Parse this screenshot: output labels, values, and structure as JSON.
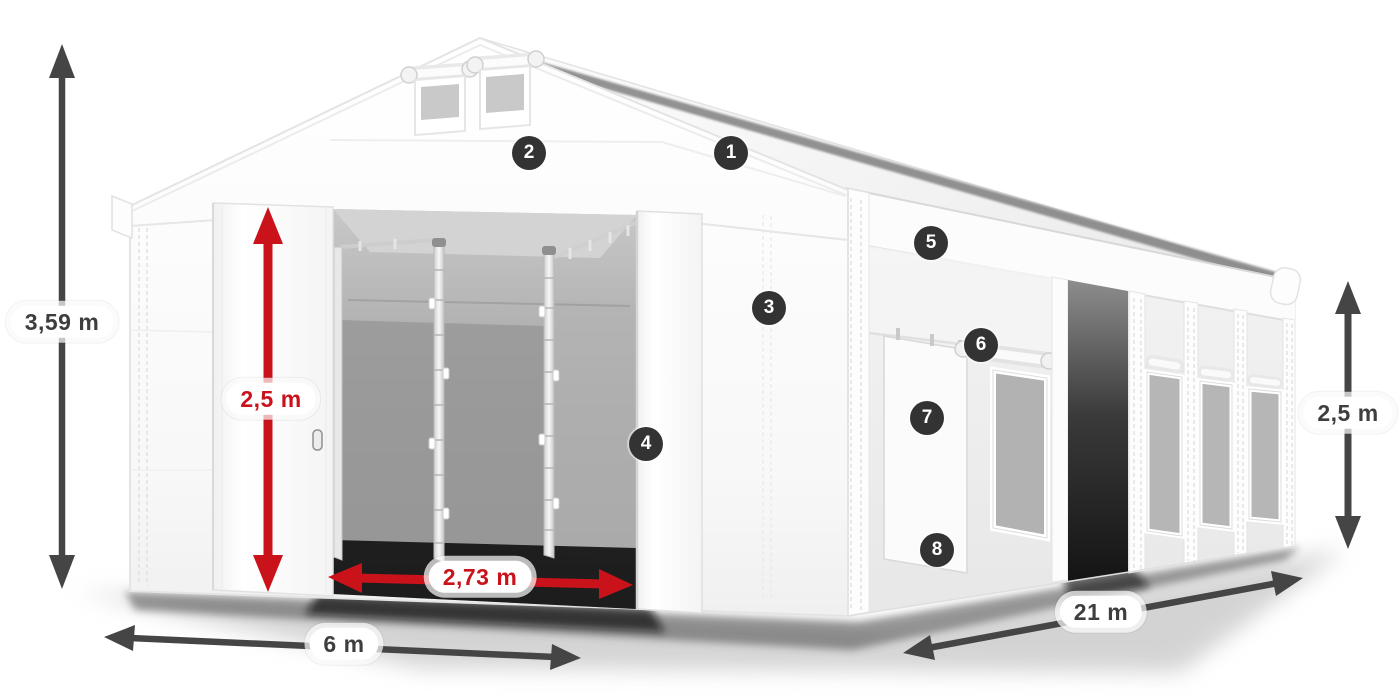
{
  "dimensions": {
    "total_height": {
      "value": "3,59 m"
    },
    "door_height": {
      "value": "2,5 m"
    },
    "door_width": {
      "value": "2,73 m"
    },
    "front_width": {
      "value": "6 m"
    },
    "length": {
      "value": "21 m"
    },
    "side_height": {
      "value": "2,5 m"
    }
  },
  "badges": [
    "1",
    "2",
    "3",
    "4",
    "5",
    "6",
    "7",
    "8"
  ],
  "icons": {
    "dimension_arrow": "double-headed-arrow"
  },
  "colors": {
    "accent_red": "#c9121a",
    "arrow_dark": "#454545",
    "badge_bg": "#333333",
    "badge_text": "#ffffff",
    "label_bg": "#ffffff",
    "label_text": "#3e3e3e",
    "tent_white": "#fafafa",
    "interior_gray": "#9e9e9e"
  }
}
